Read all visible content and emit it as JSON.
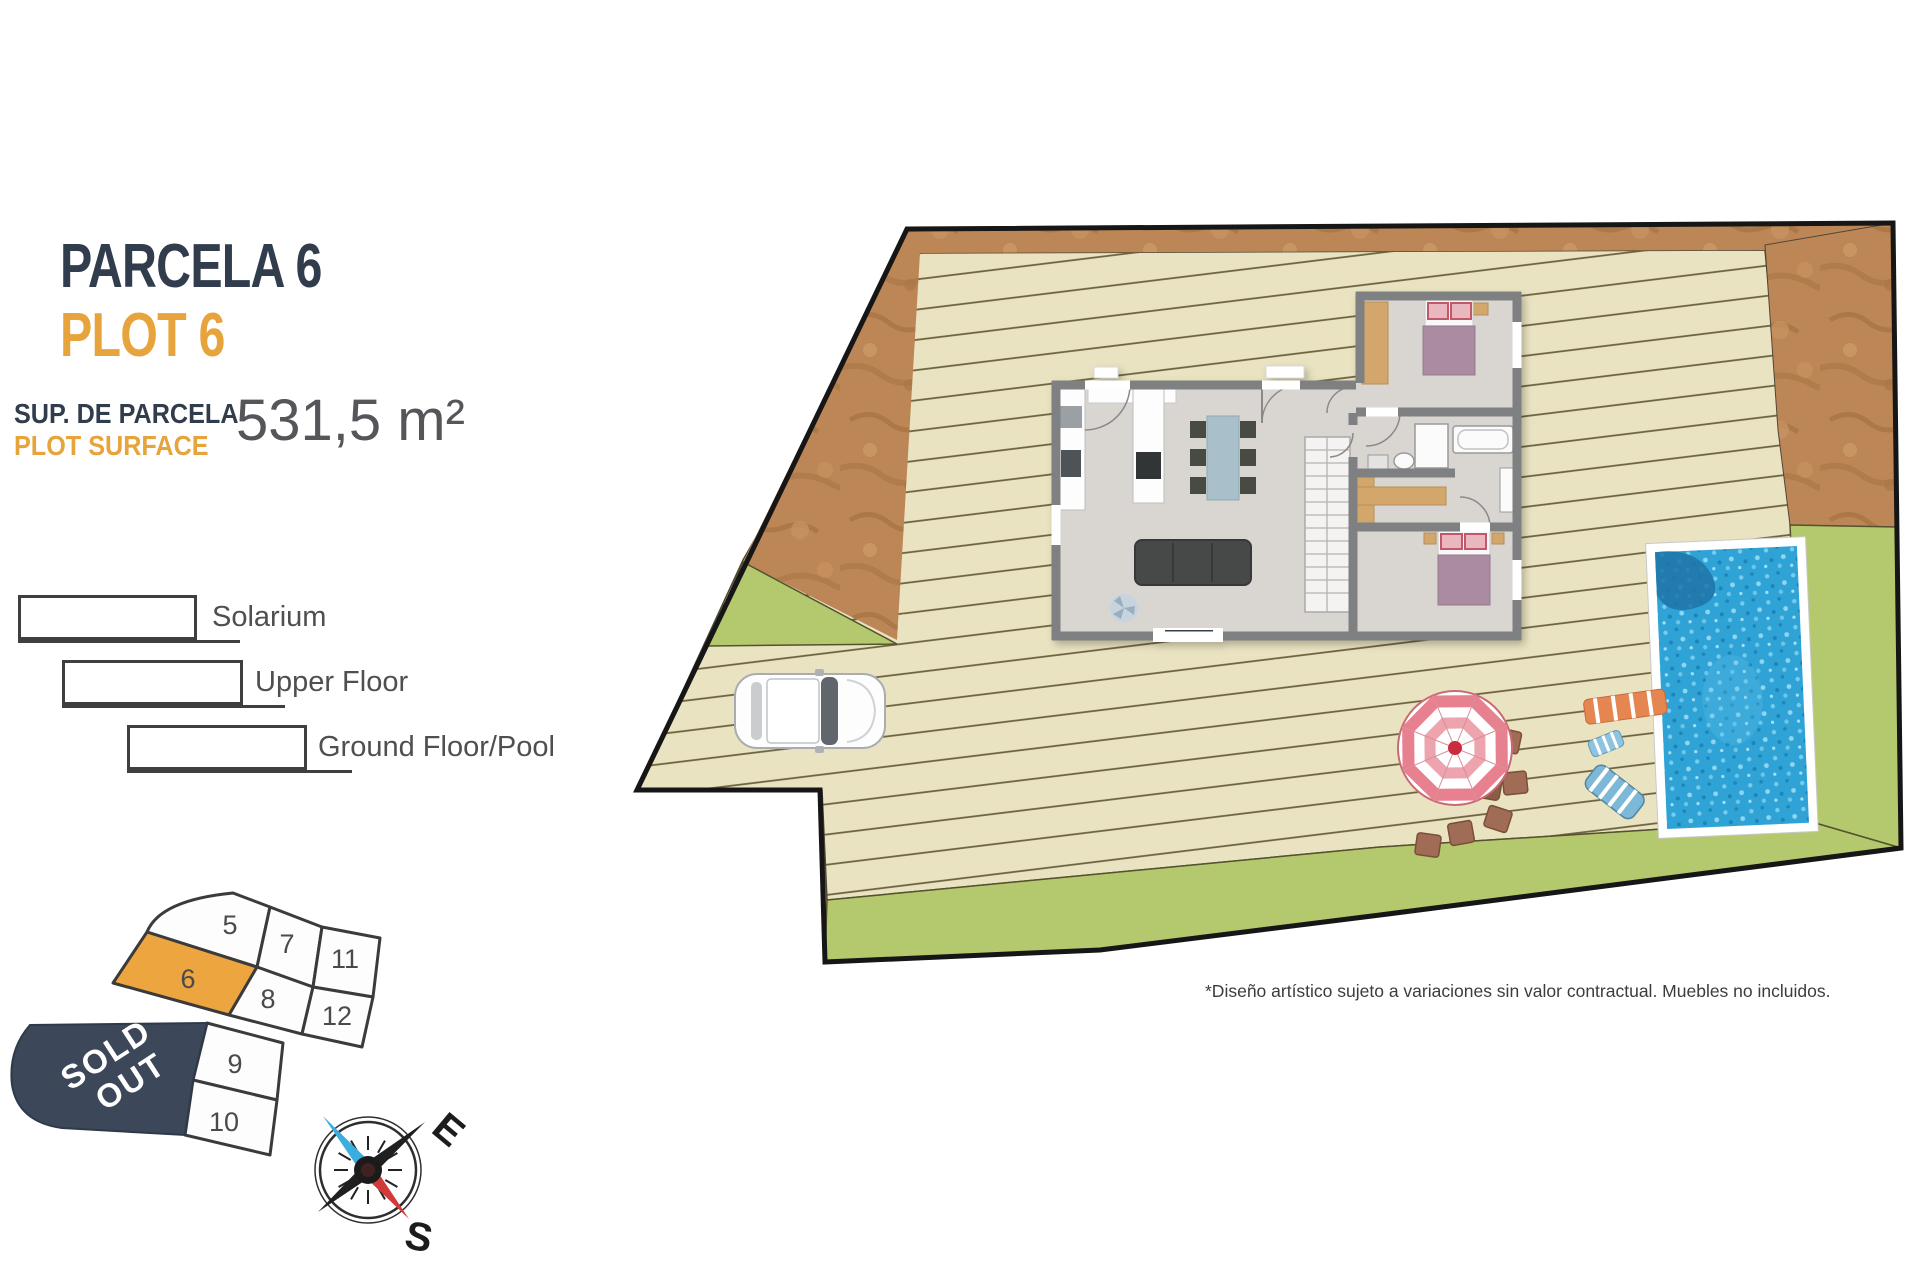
{
  "header": {
    "title_primary": "PARCELA 6",
    "title_secondary": "PLOT 6",
    "surface_label_primary": "SUP. DE PARCELA",
    "surface_label_secondary": "PLOT SURFACE",
    "surface_value": "531,5 m²"
  },
  "legend": {
    "items": [
      {
        "id": "solarium",
        "label": "Solarium"
      },
      {
        "id": "upper-floor",
        "label": "Upper Floor"
      },
      {
        "id": "ground-floor-pool",
        "label": "Ground Floor/Pool"
      }
    ]
  },
  "key_plan": {
    "highlighted_plot": "6",
    "plots": [
      {
        "number": "5"
      },
      {
        "number": "7"
      },
      {
        "number": "11"
      },
      {
        "number": "6"
      },
      {
        "number": "8"
      },
      {
        "number": "12"
      },
      {
        "number": "9"
      },
      {
        "number": "10"
      }
    ],
    "sold_out_line1": "SOLD",
    "sold_out_line2": "OUT"
  },
  "compass": {
    "east_label": "E",
    "south_label": "S"
  },
  "disclaimer": "*Diseño artístico sujeto a variaciones sin valor contractual. Muebles no incluidos.",
  "colors": {
    "navy": "#313d4d",
    "accent_orange": "#e8a43c",
    "highlight_plot_fill": "#eca53f",
    "sold_out_fill": "#3c4859",
    "deck": "#eae3c1",
    "terrain_brown": "#bd8656",
    "grass_green": "#b4c96d",
    "pool_water": "#2fa3d6",
    "house_floor": "#d9d6d1",
    "house_wall": "#7e8082"
  }
}
